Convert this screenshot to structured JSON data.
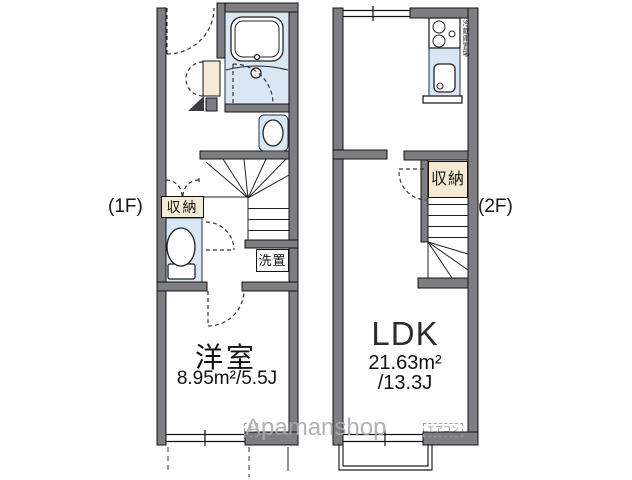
{
  "floor1": {
    "label": "(1F)",
    "room_name": "洋室",
    "room_area": "8.95m²/5.5J",
    "storage": "収納",
    "laundry": "洗置",
    "aircon": "エアコン"
  },
  "floor2": {
    "label": "(2F)",
    "room_name": "LDK",
    "room_area_line1": "21.63m²",
    "room_area_line2": "/13.3J",
    "storage": "収納",
    "fridge": "冷蔵庫置場",
    "aircon": "エアコン"
  },
  "watermark": "Apamanshop",
  "colors": {
    "wall-color": "#7d7d82",
    "water-color": "#d9e7f4",
    "storage-color": "#f4ebd2"
  }
}
